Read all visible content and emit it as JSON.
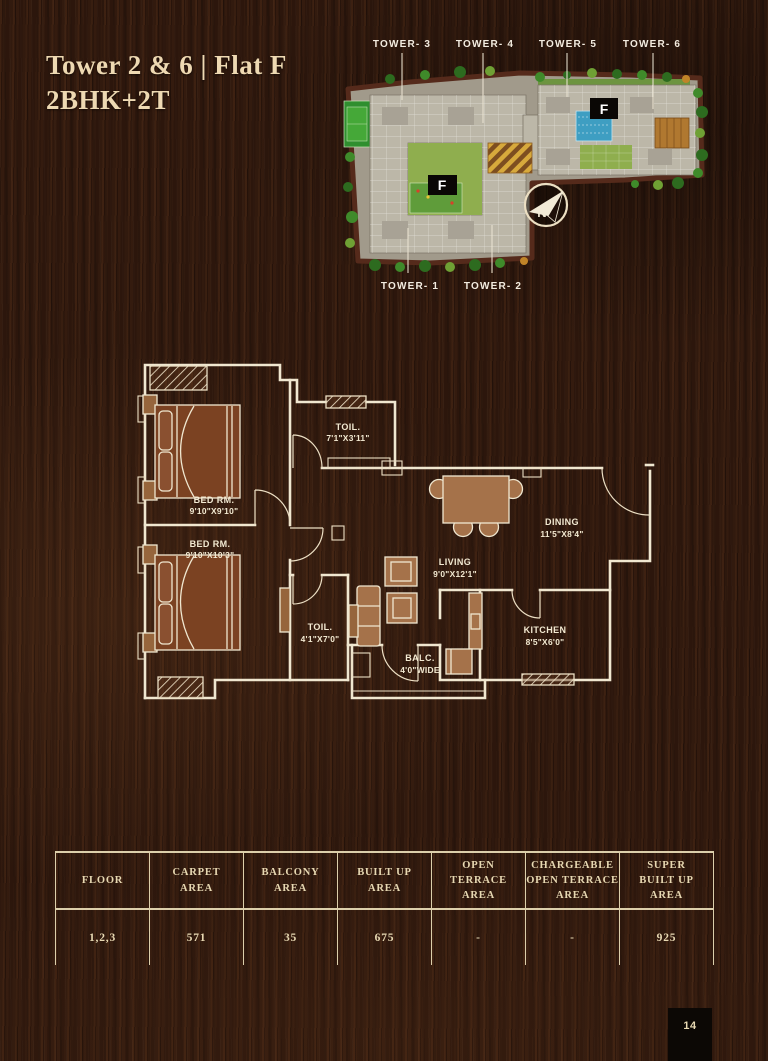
{
  "page": {
    "title_line1": "Tower 2 & 6 | Flat F",
    "title_line2": "2BHK+2T",
    "page_number": "14"
  },
  "site_plan": {
    "towers_top": [
      "TOWER- 3",
      "TOWER- 4",
      "TOWER- 5",
      "TOWER- 6"
    ],
    "towers_bottom": [
      "TOWER- 1",
      "TOWER- 2"
    ],
    "flat_marker": "F",
    "compass_letter": "N"
  },
  "floor_plan": {
    "rooms": [
      {
        "name": "BED RM.",
        "size": "9'10\"X9'10\""
      },
      {
        "name": "TOIL.",
        "size": "7'1\"X3'11\""
      },
      {
        "name": "BED RM.",
        "size": "9'10\"X10'3\""
      },
      {
        "name": "DINING",
        "size": "11'5\"X8'4\""
      },
      {
        "name": "LIVING",
        "size": "9'0\"X12'1\""
      },
      {
        "name": "TOIL.",
        "size": "4'1\"X7'0\""
      },
      {
        "name": "KITCHEN",
        "size": "8'5\"X6'0\""
      },
      {
        "name": "BALC.",
        "size": "4'0\"WIDE"
      }
    ]
  },
  "table": {
    "headers": [
      "FLOOR",
      "CARPET\nAREA",
      "BALCONY\nAREA",
      "BUILT UP\nAREA",
      "OPEN\nTERRACE\nAREA",
      "CHARGEABLE\nOPEN TERRACE\nAREA",
      "SUPER\nBUILT UP\nAREA"
    ],
    "values": [
      "1,2,3",
      "571",
      "35",
      "675",
      "-",
      "-",
      "925"
    ]
  },
  "colors": {
    "accent_cream": "#eed9b2",
    "plan_line": "#f0e7d0",
    "bed_brown": "#7b4222",
    "furniture_tan": "#a5724a",
    "marker_black": "#0a0705"
  }
}
